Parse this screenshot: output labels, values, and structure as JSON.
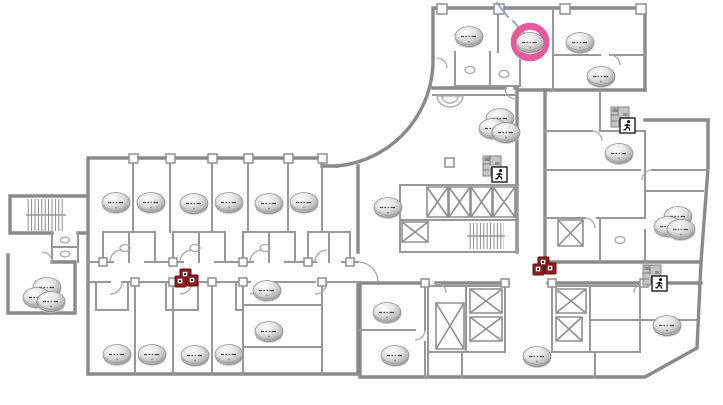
{
  "scene": {
    "background": "#ffffff",
    "wall_color": "#8a8a8a",
    "inner_wall_color": "#989898",
    "detail_color": "#a8a8a8"
  },
  "devices": {
    "access_points": [
      {
        "x": 116,
        "y": 203
      },
      {
        "x": 151,
        "y": 203
      },
      {
        "x": 194,
        "y": 204
      },
      {
        "x": 229,
        "y": 203
      },
      {
        "x": 269,
        "y": 204
      },
      {
        "x": 304,
        "y": 203
      },
      {
        "x": 117,
        "y": 355
      },
      {
        "x": 152,
        "y": 355
      },
      {
        "x": 195,
        "y": 356
      },
      {
        "x": 229,
        "y": 355
      },
      {
        "x": 267,
        "y": 291
      },
      {
        "x": 269,
        "y": 332
      },
      {
        "x": 47,
        "y": 288
      },
      {
        "x": 37,
        "y": 298
      },
      {
        "x": 51,
        "y": 302
      },
      {
        "x": 388,
        "y": 208
      },
      {
        "x": 500,
        "y": 119
      },
      {
        "x": 493,
        "y": 129
      },
      {
        "x": 506,
        "y": 133
      },
      {
        "x": 469,
        "y": 37
      },
      {
        "x": 530,
        "y": 43,
        "selected": true
      },
      {
        "x": 580,
        "y": 43
      },
      {
        "x": 601,
        "y": 77
      },
      {
        "x": 619,
        "y": 154
      },
      {
        "x": 678,
        "y": 217
      },
      {
        "x": 668,
        "y": 227
      },
      {
        "x": 681,
        "y": 230
      },
      {
        "x": 387,
        "y": 313
      },
      {
        "x": 395,
        "y": 356
      },
      {
        "x": 537,
        "y": 357
      },
      {
        "x": 667,
        "y": 326
      }
    ],
    "selection_ring": {
      "x": 530,
      "y": 42,
      "radius": 15.5,
      "thickness": 6.5,
      "color": "#e8589b",
      "rim_color": "#d9458c"
    },
    "switch_clusters": [
      {
        "x": 185,
        "y": 281
      },
      {
        "x": 543,
        "y": 269
      }
    ],
    "floor_exit_markers": [
      {
        "x": 495,
        "y": 170
      },
      {
        "x": 623,
        "y": 121
      },
      {
        "x": 655,
        "y": 279
      }
    ],
    "annotation_color": "#85a8d8",
    "annotation_segments": [
      {
        "x1": 497,
        "y1": 3,
        "x2": 508,
        "y2": 17
      },
      {
        "x1": 513,
        "y1": 21,
        "x2": 524,
        "y2": 33
      }
    ]
  },
  "counts": {
    "access_points": 31,
    "switch_clusters": 2,
    "floor_exit_markers": 3,
    "selected_access_points": 1
  }
}
